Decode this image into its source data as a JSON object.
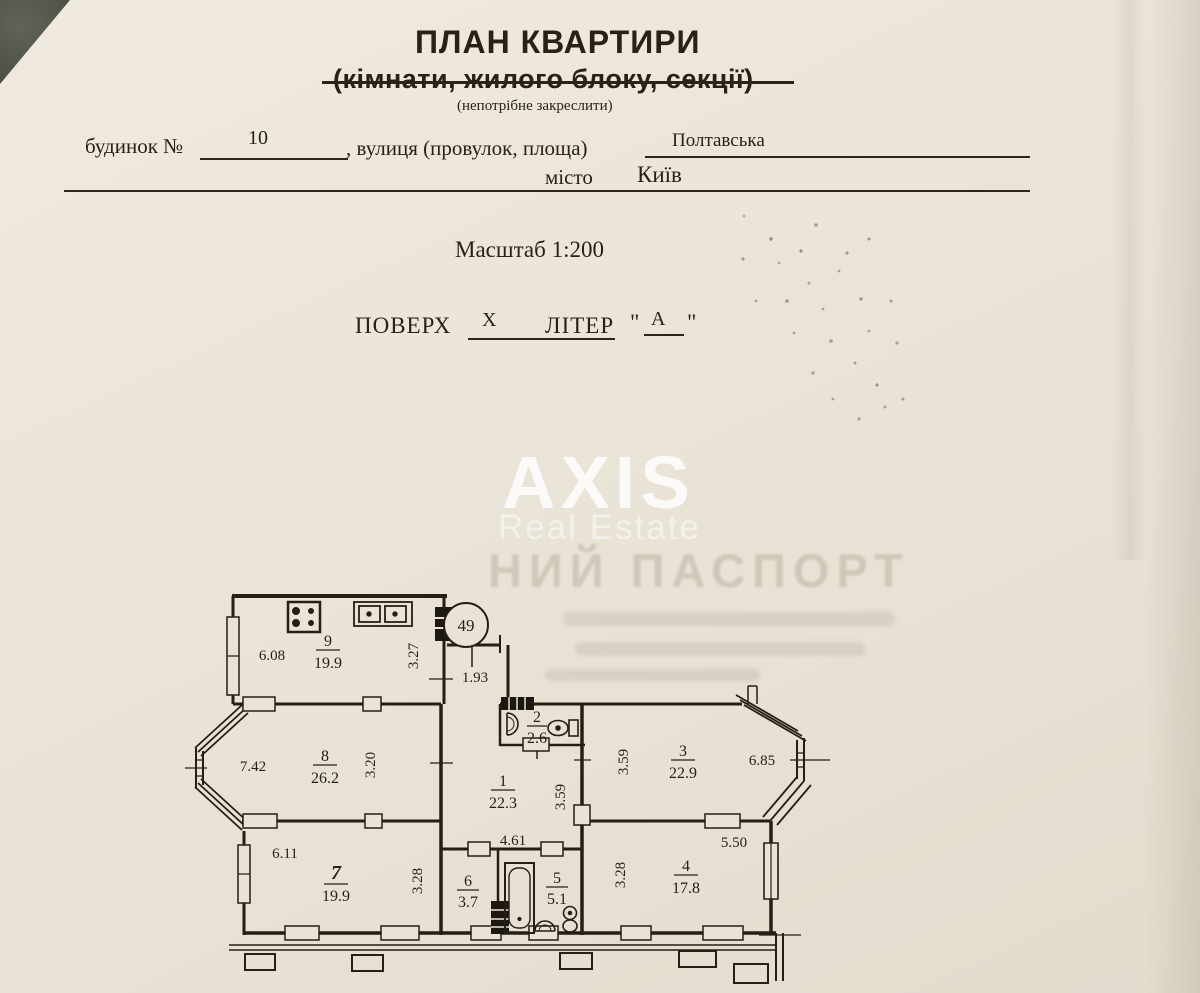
{
  "colors": {
    "paper": "#eae4d8",
    "ink": "#272117",
    "table_corner": "#53564a",
    "watermark": "#ffffff"
  },
  "header": {
    "title": "ПЛАН КВАРТИРИ",
    "subtitle": "(кімнати, жилого блоку, секції)",
    "note": "(непотрібне закреслити)"
  },
  "form": {
    "building_label": "будинок №",
    "building_number": "10",
    "street_label": ", вулиця (провулок, площа)",
    "street_value": "Полтавська",
    "city_label": "місто",
    "city_value": "Київ",
    "scale": "Масштаб 1:200",
    "floor_label": "ПОВЕРХ",
    "floor_value": "X",
    "letter_label": "ЛІТЕР",
    "quote_mark": "\"",
    "letter_value": "А"
  },
  "watermark": {
    "brand": "AXIS",
    "subtitle": "Real Estate",
    "bleed_text": "НИЙ ПАСПОРТ"
  },
  "plan": {
    "apartment_number": "49",
    "rooms": {
      "r1": {
        "number": "1",
        "area": "22.3"
      },
      "r2": {
        "number": "2",
        "area": "2.6"
      },
      "r3": {
        "number": "3",
        "area": "22.9"
      },
      "r4": {
        "number": "4",
        "area": "17.8"
      },
      "r5": {
        "number": "5",
        "area": "5.1"
      },
      "r6": {
        "number": "6",
        "area": "3.7"
      },
      "r7": {
        "number": "7",
        "area": "19.9"
      },
      "r8": {
        "number": "8",
        "area": "26.2"
      },
      "r9": {
        "number": "9",
        "area": "19.9"
      }
    },
    "dimensions": {
      "kitchen_w": "6.08",
      "kitchen_d": "3.27",
      "entry": "1.93",
      "room8_w": "7.42",
      "room8_d": "3.20",
      "room7_w": "6.11",
      "room7_d": "3.28",
      "hall_d": "3.59",
      "hall_w": "4.61",
      "room3_d": "3.59",
      "room3_w": "6.85",
      "room4_d": "3.28",
      "room4_w": "5.50"
    }
  }
}
